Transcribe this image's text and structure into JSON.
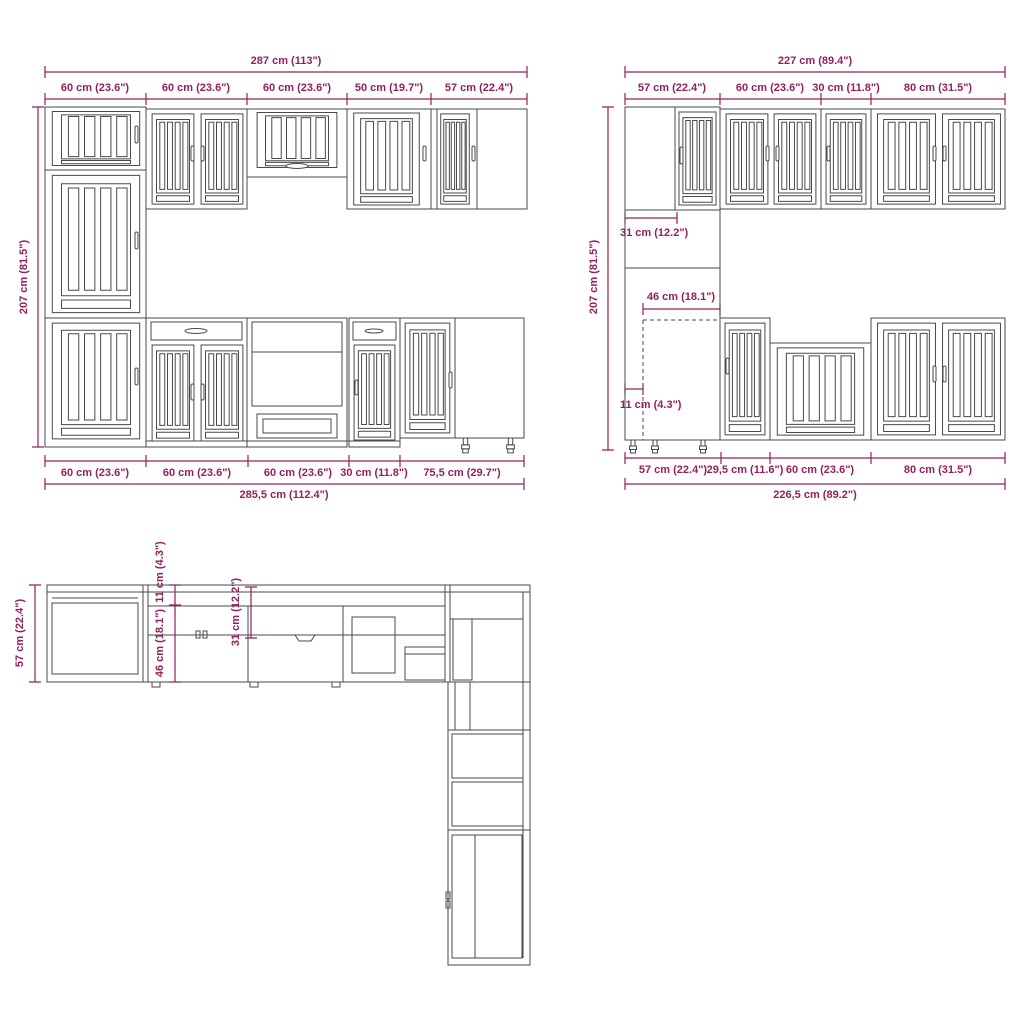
{
  "title": "Kitchen cabinet set dimension diagram",
  "colors": {
    "dimension": "#94205c",
    "line": "#4a4a4a",
    "background": "#ffffff"
  },
  "front_left": {
    "total_width_top": "287 cm (113\")",
    "top_segments": [
      "60 cm (23.6\")",
      "60 cm (23.6\")",
      "60 cm (23.6\")",
      "50 cm (19.7\")",
      "57 cm (22.4\")"
    ],
    "height": "207 cm (81.5\")",
    "bottom_segments": [
      "60 cm (23.6\")",
      "60 cm (23.6\")",
      "60 cm (23.6\")",
      "30 cm (11.8\")",
      "75,5 cm (29.7\")"
    ],
    "total_width_bottom": "285,5 cm (112.4\")"
  },
  "front_right": {
    "total_width_top": "227 cm (89.4\")",
    "top_segments": [
      "57 cm (22.4\")",
      "60 cm (23.6\")",
      "30 cm (11.8\")",
      "80 cm (31.5\")"
    ],
    "height": "207 cm (81.5\")",
    "wall_cabinet_depth": "31 cm (12.2\")",
    "base_cabinet_depth": "46 cm (18.1\")",
    "plinth_inset": "11 cm (4.3\")",
    "bottom_segments": [
      "57 cm (22.4\")",
      "29,5 cm (11.6\")",
      "60 cm (23.6\")",
      "80 cm (31.5\")"
    ],
    "total_width_bottom": "226,5 cm (89.2\")"
  },
  "plan_view": {
    "counter_depth": "57 cm (22.4\")",
    "plinth_inset": "11 cm (4.3\")",
    "base_cabinet_depth": "46 cm (18.1\")",
    "wall_cabinet_depth": "31 cm (12.2\")"
  }
}
